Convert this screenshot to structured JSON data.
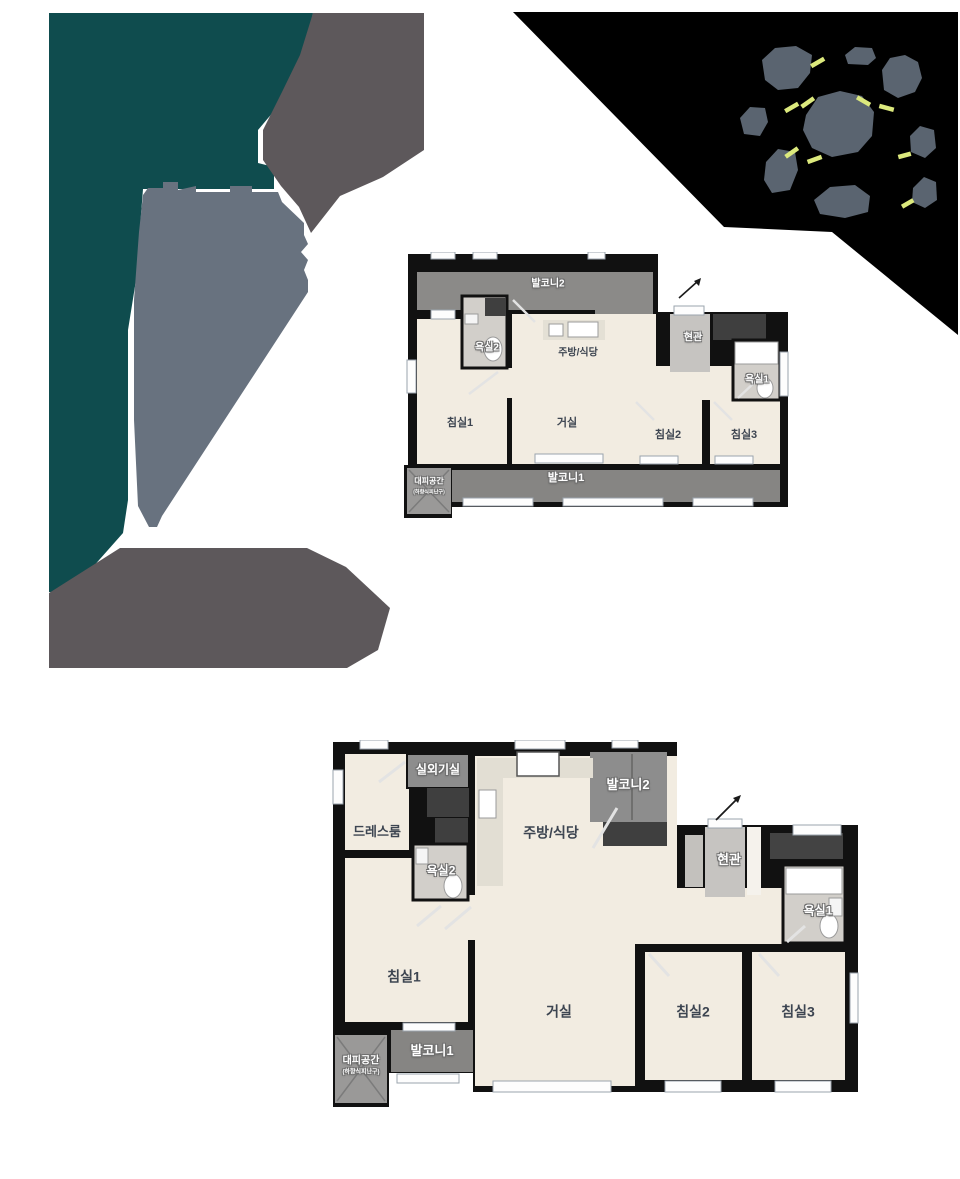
{
  "colors": {
    "teal": "#0f4c4e",
    "slate_gray": "#68727f",
    "warm_gray": "#5d585b",
    "site_black": "#000000",
    "rock_gray": "#5a6470",
    "dash_green": "#dce97d",
    "wall_black": "#111111",
    "floor_cream": "#f2ece1",
    "balcony_gray": "#8b8a88",
    "label_dark": "#3d4551"
  },
  "plans": {
    "small": {
      "labels": {
        "balcony2": "발코니2",
        "bath2": "욕실2",
        "kitchen_dining": "주방/식당",
        "entrance": "현관",
        "bath1": "욕실1",
        "bedroom1": "침실1",
        "living": "거실",
        "bedroom2": "침실2",
        "bedroom3": "침실3",
        "balcony1": "발코니1",
        "evac": "대피공간",
        "evac_sub": "(하향식피난구)"
      }
    },
    "large": {
      "labels": {
        "outdoor_unit": "실외기실",
        "dressroom": "드레스룸",
        "bath2": "욕실2",
        "kitchen_dining": "주방/식당",
        "balcony2": "발코니2",
        "entrance": "현관",
        "bath1": "욕실1",
        "bedroom1": "침실1",
        "living": "거실",
        "bedroom2": "침실2",
        "bedroom3": "침실3",
        "balcony1": "발코니1",
        "evac": "대피공간",
        "evac_sub": "(하향식피난구)"
      }
    }
  }
}
